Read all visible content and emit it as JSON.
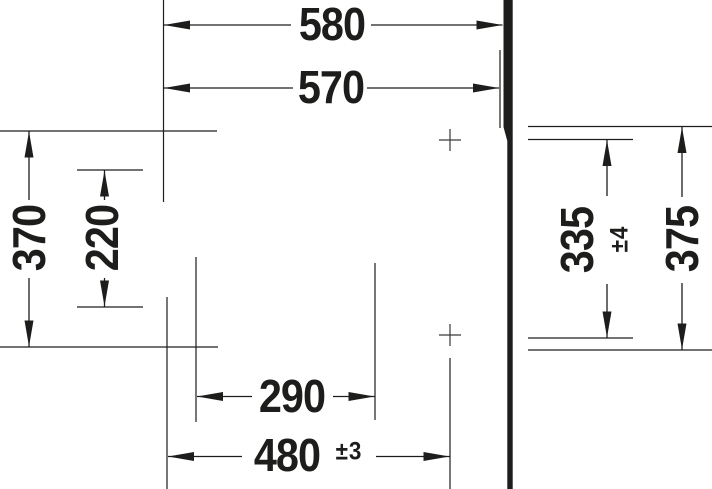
{
  "labels": {
    "overall_width": "580",
    "basin_width": "570",
    "left_height_outer": "370",
    "left_height_inner": "220",
    "right_height_inner": "335",
    "right_height_inner_tolerance": "±4",
    "right_height_outer": "375",
    "bottom_width_inner": "290",
    "bottom_width_outer": "480",
    "bottom_width_outer_tolerance": "±3"
  },
  "colors": {
    "line": "#1d1d1b",
    "marker": "#3a3a38",
    "background": "#ffffff"
  }
}
